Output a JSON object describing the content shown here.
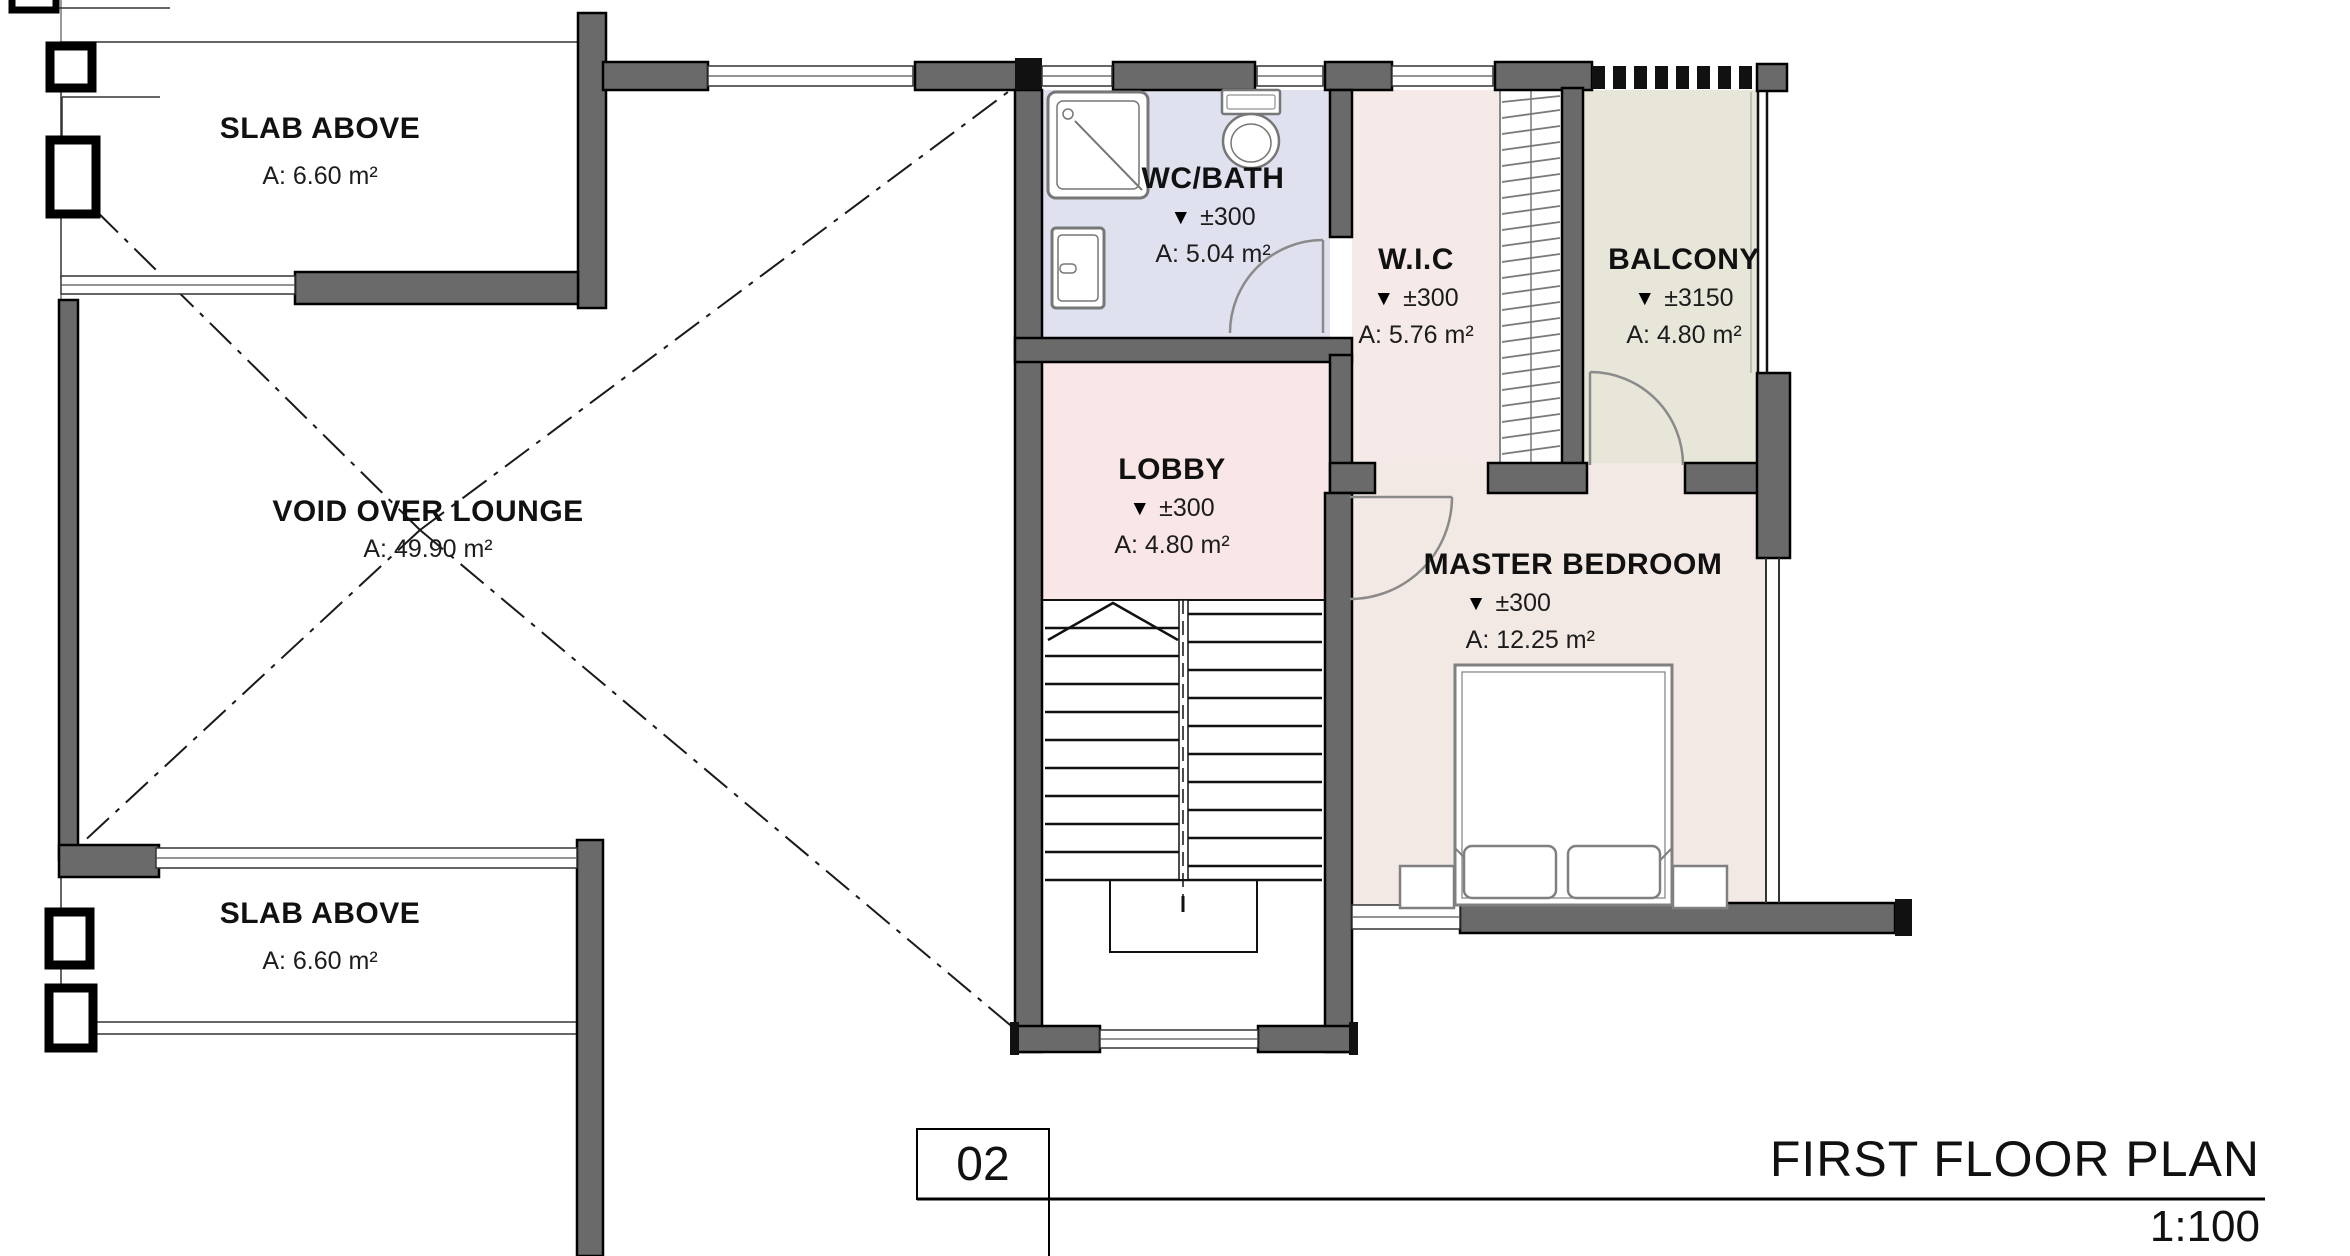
{
  "plan": {
    "level_marker": "▼",
    "rooms": {
      "slab_top": {
        "name": "SLAB ABOVE",
        "area": "A: 6.60 m²"
      },
      "slab_bottom": {
        "name": "SLAB ABOVE",
        "area": "A: 6.60 m²"
      },
      "void": {
        "name": "VOID OVER LOUNGE",
        "area": "A: 49.90 m²"
      },
      "wc_bath": {
        "name": "WC/BATH",
        "level": "±300",
        "area": "A: 5.04 m²"
      },
      "wic": {
        "name": "W.I.C",
        "level": "±300",
        "area": "A: 5.76 m²"
      },
      "balcony": {
        "name": "BALCONY",
        "level": "±3150",
        "area": "A: 4.80 m²"
      },
      "lobby": {
        "name": "LOBBY",
        "level": "±300",
        "area": "A: 4.80 m²"
      },
      "master_bedroom": {
        "name": "MASTER BEDROOM",
        "level": "±300",
        "area": "A: 12.25 m²"
      }
    },
    "title_block": {
      "number": "02",
      "title": "FIRST FLOOR PLAN",
      "scale": "1:100"
    },
    "colors": {
      "wall": "#6a6a6a",
      "wc_floor": "#e0e1ef",
      "wic_floor": "#f5eae7",
      "balcony_floor": "#e8e6d9",
      "lobby_floor": "#f9e6e6",
      "bedroom_floor": "#f2e9e5"
    }
  }
}
